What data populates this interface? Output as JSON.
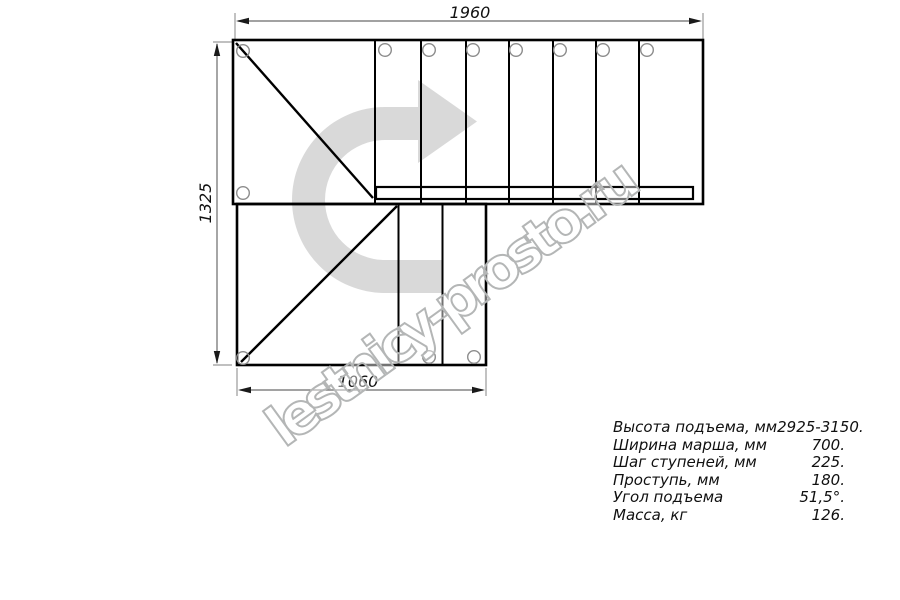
{
  "drawing": {
    "type": "staircase-plan-top-view",
    "dimensions": {
      "top_width": "1960",
      "left_height": "1325",
      "bottom_width": "1060"
    },
    "arrow_color": "#d9d9d9",
    "line_color": "#000000"
  },
  "watermark": {
    "text": "lestnicy-prosto.ru",
    "outline_color": "#b4b6b6"
  },
  "specs": {
    "rows": [
      {
        "label": "Высота подъема, мм",
        "value": "2925-3150."
      },
      {
        "label": "Ширина марша, мм",
        "value": "700."
      },
      {
        "label": "Шаг ступеней, мм",
        "value": "225."
      },
      {
        "label": "Проступь, мм",
        "value": "180."
      },
      {
        "label": "Угол подъема",
        "value": "51,5°."
      },
      {
        "label": "Масса, кг",
        "value": "126."
      }
    ]
  }
}
